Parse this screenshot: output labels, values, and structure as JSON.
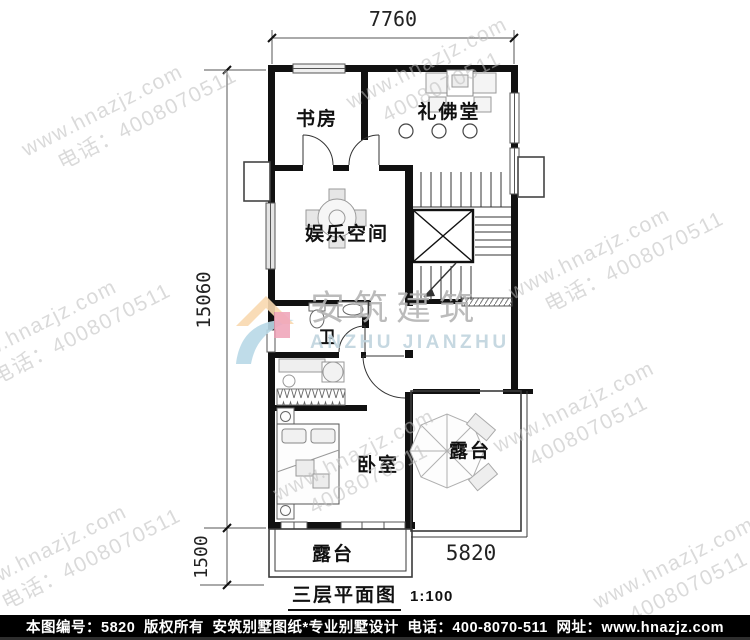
{
  "dimensions": {
    "top_width": "7760",
    "left_total": "15060",
    "left_terrace": "1500",
    "bottom_terrace_width": "5820"
  },
  "rooms": {
    "study": "书房",
    "buddha_hall": "礼佛堂",
    "entertainment": "娱乐空间",
    "bathroom": "卫",
    "bedroom": "卧室",
    "terrace_right": "露台",
    "terrace_bottom": "露台"
  },
  "title": {
    "text": "三层平面图",
    "scale": "1:100"
  },
  "watermark": {
    "site": "www.hnazjz.com",
    "phone_label": "电话：4008070511",
    "phone_number": "4008070511",
    "brand_cn": "安筑建筑",
    "brand_en": "ANZHU JIANZHU"
  },
  "footer": {
    "plan_no": "本图编号：5820",
    "copyright": "版权所有",
    "brand": "安筑别墅图纸*专业别墅设计",
    "phone": "电话：400-8070-511",
    "website": "网址：www.hnazjz.com"
  },
  "colors": {
    "wall": "#111111",
    "furniture": "#9e9e9e",
    "watermark": "#bdbdbd",
    "footer_bg": "#000000",
    "footer_text": "#ffffff"
  }
}
